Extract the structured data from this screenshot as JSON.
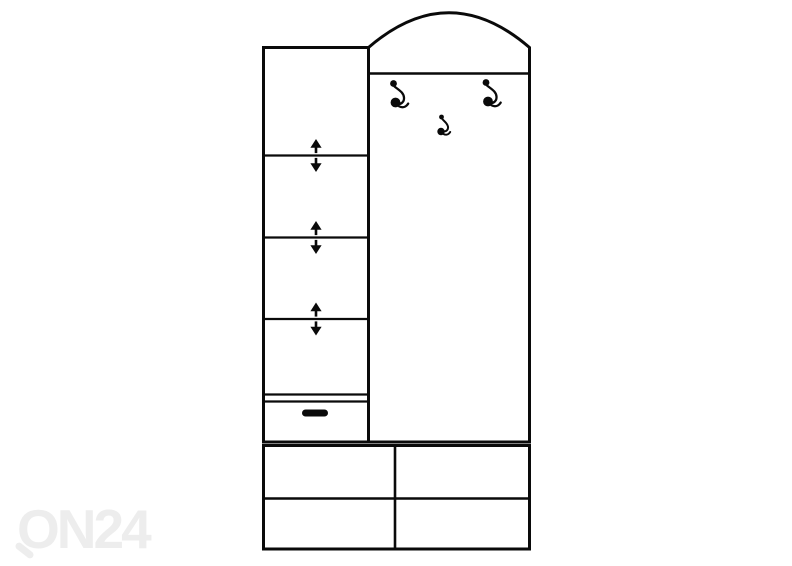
{
  "watermark": {
    "text": "ON24"
  },
  "colors": {
    "line": "#0a0a0a",
    "background": "#ffffff",
    "watermark": "#ededed"
  },
  "drawing": {
    "description": "Black and white line drawing of a hallway wardrobe unit",
    "left_cabinet": {
      "open_compartments": 4,
      "adjustable_shelf_markers": 3,
      "drawers": 1,
      "drawer_handles": 1
    },
    "coat_panel": {
      "arched_top": true,
      "large_hooks": 2,
      "small_hooks": 1
    },
    "bottom_unit": {
      "compartments": 4,
      "rows": 2,
      "columns": 2
    }
  }
}
